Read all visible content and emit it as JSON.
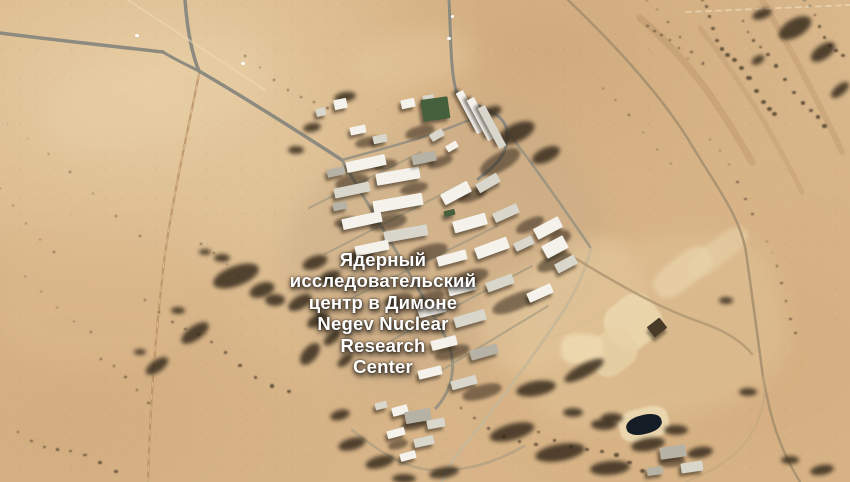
{
  "location_label": {
    "lines": [
      "Ядерный",
      "исследовательский",
      "центр в Димоне",
      "Negev Nuclear",
      "Research",
      "Center"
    ],
    "language_ru": "Ядерный исследовательский центр в Димоне",
    "language_en": "Negev Nuclear Research Center",
    "text_color": "#ffffff"
  },
  "palette": {
    "sand_base": "#d9b78b",
    "sand_light": "#ecd7ae",
    "sand_dark": "#c8a275",
    "road_asphalt": "#8d8a80",
    "dirt_track": "#bb9265",
    "scrub": "#33281a",
    "shadow": "#241a10",
    "bldg": {
      "w": "#f4f2eb",
      "l": "#d9d6cc",
      "g": "#b6b2a6",
      "green": "#44603c",
      "pond": "#141c25",
      "pit": "#4a3b28",
      "dot": "#ffffff"
    }
  },
  "scene": {
    "pads": [
      [
        445,
        245,
        310,
        240,
        -30,
        "#c9ab87",
        0.5,
        14
      ],
      [
        560,
        305,
        170,
        100,
        -30,
        "#e5c99e",
        0.5,
        8
      ],
      [
        650,
        330,
        270,
        180,
        -12,
        "#e2c79b",
        0.45,
        10
      ],
      [
        155,
        95,
        220,
        80,
        -15,
        "#e8d0a6",
        0.45,
        12
      ],
      [
        95,
        300,
        190,
        130,
        0,
        "#debb8f",
        0.4,
        12
      ],
      [
        410,
        60,
        120,
        50,
        -10,
        "#e6cda2",
        0.4,
        10
      ],
      [
        745,
        180,
        160,
        90,
        -20,
        "#d7b488",
        0.4,
        12
      ],
      [
        633,
        322,
        54,
        50,
        -38,
        "#ecd7ae",
        0.9,
        1
      ],
      [
        612,
        352,
        48,
        42,
        -38,
        "#e7d0a5",
        0.9,
        1
      ],
      [
        683,
        272,
        66,
        30,
        -38,
        "#ead5ab",
        0.7,
        2
      ],
      [
        718,
        252,
        70,
        24,
        -38,
        "#e7d2a8",
        0.6,
        2
      ],
      [
        582,
        349,
        42,
        30,
        0,
        "#eed9b0",
        0.9,
        2
      ],
      [
        644,
        424,
        50,
        32,
        -14,
        "#ecd8b0",
        0.95,
        1
      ]
    ],
    "roads": [
      [
        "M640,18 C692,62 722,110 752,162",
        "rgba(150,108,66,0.18)",
        7,
        1,
        ""
      ],
      [
        "M762,0 C792,52 816,96 842,152",
        "rgba(150,108,66,0.18)",
        6,
        1,
        ""
      ],
      [
        "M700,28 C742,82 772,132 802,192",
        "rgba(150,108,66,0.15)",
        5,
        1,
        ""
      ],
      [
        "M0,33 C55,40 110,46 163,52",
        "#8d8a80",
        3.5,
        1,
        ""
      ],
      [
        "M185,0 C187,26 191,52 199,71",
        "#8d8a80",
        3.5,
        1,
        ""
      ],
      [
        "M163,52 C176,60 189,66 199,71",
        "#8d8a80",
        3,
        1,
        ""
      ],
      [
        "M199,71 C252,102 308,138 342,160",
        "#8d8a80",
        3.5,
        1,
        ""
      ],
      [
        "M342,160 C372,212 412,275 447,340 C458,366 452,390 436,408",
        "#98917f",
        3,
        0.95,
        ""
      ],
      [
        "M342,160 C378,150 410,142 438,132 C458,125 472,119 483,114",
        "#969082",
        2.5,
        0.9,
        ""
      ],
      [
        "M449,0 C451,35 450,72 457,94 C479,111 503,109 507,131 C510,154 494,167 478,179",
        "#8d8a80",
        3,
        1,
        ""
      ],
      [
        "M507,131 C532,163 558,200 582,235 C586,241 590,246 591,249",
        "#9a937f",
        2.5,
        0.9,
        ""
      ],
      [
        "M591,249 C581,288 561,316 536,351 C516,379 486,420 451,462 L442,482",
        "#c9b796",
        3,
        0.95,
        ""
      ],
      [
        "M570,255 C622,287 662,309 700,322 C726,331 741,341 752,354",
        "#b39a75",
        2.5,
        0.9,
        ""
      ],
      [
        "M568,0 C616,46 662,96 691,144 C716,186 740,216 746,252 C753,302 757,332 763,377 C771,422 781,451 800,482",
        "#a6906f",
        2.5,
        0.9,
        ""
      ],
      [
        "M199,74 C188,130 172,200 164,262 C156,330 150,400 148,482",
        "#bb9265",
        2.2,
        0.85,
        ""
      ],
      [
        "M199,74 C188,130 172,200 164,262 C156,330 150,400 148,482",
        "#ecd9b2",
        1,
        0.6,
        "5,7"
      ],
      [
        "M128,0 L265,90",
        "#ecd9b4",
        2,
        0.6,
        ""
      ],
      [
        "M686,12 L850,5",
        "#f0e3c4",
        1.8,
        0.6,
        "5,5"
      ],
      [
        "M309,208 L421,152",
        "#a1987f",
        2,
        0.75,
        ""
      ],
      [
        "M325,254 L458,186",
        "#a1987f",
        2,
        0.75,
        ""
      ],
      [
        "M348,300 L497,226",
        "#a1987f",
        2,
        0.75,
        ""
      ],
      [
        "M392,340 L532,266",
        "#a1987f",
        2,
        0.75,
        ""
      ],
      [
        "M432,376 L548,306",
        "#a1987f",
        2,
        0.7,
        ""
      ],
      [
        "M352,430 C380,452 404,468 432,470 C468,472 500,460 524,446",
        "#b4a183",
        2.5,
        0.85,
        ""
      ],
      [
        "M763,377 C768,402 758,430 737,452 C719,468 700,476 686,482",
        "#c2a77f",
        2,
        0.6,
        ""
      ],
      [
        "M548,338 C570,332 590,322 606,310",
        "#d8bd92",
        2,
        0.7,
        ""
      ]
    ],
    "scrub": [
      [
        236,
        276,
        48,
        20,
        -20
      ],
      [
        262,
        290,
        26,
        14,
        -20
      ],
      [
        275,
        300,
        20,
        12,
        0
      ],
      [
        195,
        333,
        32,
        14,
        -35
      ],
      [
        157,
        366,
        26,
        12,
        -35
      ],
      [
        300,
        302,
        26,
        13,
        -30
      ],
      [
        318,
        320,
        24,
        12,
        -30
      ],
      [
        310,
        354,
        26,
        14,
        -50
      ],
      [
        222,
        258,
        16,
        8,
        0
      ],
      [
        205,
        252,
        12,
        6,
        0
      ],
      [
        178,
        310,
        14,
        7,
        0
      ],
      [
        140,
        352,
        12,
        6,
        0
      ],
      [
        332,
        338,
        20,
        10,
        -40
      ],
      [
        345,
        360,
        18,
        9,
        -40
      ],
      [
        315,
        262,
        26,
        13,
        -20
      ],
      [
        330,
        276,
        22,
        11,
        -20
      ],
      [
        352,
        444,
        28,
        12,
        -15
      ],
      [
        380,
        462,
        30,
        12,
        -15
      ],
      [
        340,
        415,
        20,
        10,
        -15
      ],
      [
        795,
        28,
        36,
        18,
        -30
      ],
      [
        823,
        52,
        28,
        14,
        -35
      ],
      [
        762,
        14,
        20,
        10,
        -20
      ],
      [
        840,
        90,
        22,
        10,
        -40
      ],
      [
        758,
        60,
        14,
        8,
        -30
      ],
      [
        345,
        97,
        22,
        10,
        -10
      ],
      [
        312,
        127,
        18,
        9,
        -10
      ],
      [
        296,
        150,
        16,
        8,
        0
      ],
      [
        516,
        133,
        40,
        18,
        -25
      ],
      [
        546,
        155,
        30,
        14,
        -25
      ],
      [
        490,
        112,
        24,
        11,
        -20
      ],
      [
        536,
        388,
        40,
        15,
        -10
      ],
      [
        512,
        432,
        46,
        16,
        -15
      ],
      [
        560,
        452,
        50,
        17,
        -10
      ],
      [
        610,
        468,
        40,
        14,
        -5
      ],
      [
        648,
        444,
        34,
        13,
        -10
      ],
      [
        604,
        424,
        26,
        11,
        0
      ],
      [
        676,
        430,
        24,
        10,
        0
      ],
      [
        700,
        452,
        26,
        11,
        -10
      ],
      [
        584,
        370,
        44,
        13,
        -28
      ],
      [
        573,
        412,
        20,
        9,
        0
      ],
      [
        612,
        418,
        22,
        10,
        0
      ],
      [
        444,
        472,
        30,
        11,
        -10
      ],
      [
        404,
        478,
        24,
        9,
        0
      ],
      [
        822,
        470,
        24,
        10,
        -10
      ],
      [
        790,
        460,
        18,
        8,
        0
      ],
      [
        748,
        392,
        18,
        8,
        0
      ],
      [
        726,
        300,
        14,
        7,
        0
      ]
    ],
    "chains": [
      [
        700,
        2,
        770,
        115,
        14,
        4
      ],
      [
        745,
        18,
        820,
        130,
        12,
        3.5
      ],
      [
        800,
        2,
        848,
        58,
        8,
        3
      ],
      [
        688,
        58,
        652,
        22,
        6,
        3
      ],
      [
        140,
        300,
        290,
        392,
        11,
        3
      ],
      [
        15,
        432,
        120,
        470,
        8,
        3
      ],
      [
        5,
        192,
        52,
        250,
        5,
        2.5
      ],
      [
        240,
        60,
        330,
        112,
        7,
        2.5
      ],
      [
        10,
        120,
        140,
        232,
        7,
        2
      ],
      [
        540,
        432,
        640,
        470,
        8,
        4
      ],
      [
        462,
        412,
        540,
        446,
        6,
        3.5
      ],
      [
        652,
        2,
        700,
        60,
        6,
        2.5
      ],
      [
        710,
        140,
        748,
        210,
        6,
        2.5
      ],
      [
        762,
        240,
        800,
        330,
        7,
        2.5
      ],
      [
        608,
        90,
        668,
        160,
        6,
        2
      ],
      [
        196,
        248,
        236,
        272,
        4,
        2.5
      ],
      [
        96,
        360,
        150,
        400,
        5,
        2.5
      ],
      [
        30,
        280,
        90,
        330,
        5,
        2
      ]
    ],
    "shade": [
      [
        352,
        182,
        34,
        14,
        -12
      ],
      [
        388,
        222,
        38,
        15,
        -12
      ],
      [
        428,
        252,
        40,
        15,
        -15
      ],
      [
        468,
        278,
        42,
        15,
        -18
      ],
      [
        516,
        302,
        50,
        16,
        -22
      ],
      [
        554,
        262,
        36,
        14,
        -25
      ],
      [
        500,
        162,
        44,
        18,
        -30
      ],
      [
        420,
        132,
        30,
        12,
        -15
      ],
      [
        368,
        142,
        26,
        10,
        -12
      ],
      [
        452,
        352,
        36,
        13,
        -15
      ],
      [
        482,
        392,
        40,
        14,
        -15
      ],
      [
        430,
        298,
        30,
        12,
        -15
      ],
      [
        530,
        225,
        30,
        12,
        -25
      ],
      [
        472,
        195,
        30,
        12,
        -20
      ],
      [
        414,
        188,
        28,
        11,
        -12
      ],
      [
        360,
        255,
        28,
        11,
        -12
      ],
      [
        398,
        300,
        30,
        12,
        -14
      ],
      [
        414,
        425,
        26,
        10,
        -12
      ],
      [
        398,
        444,
        20,
        9,
        -15
      ],
      [
        672,
        462,
        26,
        10,
        -5
      ],
      [
        560,
        238,
        22,
        14,
        -25
      ],
      [
        440,
        162,
        26,
        10,
        -20
      ],
      [
        385,
        165,
        24,
        10,
        -12
      ],
      [
        345,
        222,
        22,
        10,
        -12
      ]
    ],
    "buildings": [
      [
        340,
        104,
        13,
        10,
        -12,
        "w"
      ],
      [
        321,
        112,
        10,
        8,
        -12,
        "l"
      ],
      [
        358,
        130,
        16,
        8,
        -12,
        "w"
      ],
      [
        380,
        139,
        14,
        8,
        -12,
        "l"
      ],
      [
        408,
        103,
        14,
        9,
        -12,
        "w"
      ],
      [
        428,
        99,
        11,
        8,
        -10,
        "l"
      ],
      [
        435,
        109,
        27,
        22,
        -8,
        "green"
      ],
      [
        470,
        112,
        46,
        8,
        62,
        "w"
      ],
      [
        481,
        119,
        46,
        8,
        62,
        "w"
      ],
      [
        492,
        127,
        46,
        8,
        62,
        "l"
      ],
      [
        437,
        135,
        14,
        8,
        -30,
        "l"
      ],
      [
        452,
        146,
        12,
        7,
        -30,
        "w"
      ],
      [
        366,
        163,
        40,
        11,
        -12,
        "w"
      ],
      [
        336,
        172,
        18,
        8,
        -12,
        "g"
      ],
      [
        398,
        176,
        44,
        12,
        -10,
        "w"
      ],
      [
        352,
        190,
        36,
        10,
        -12,
        "l"
      ],
      [
        398,
        203,
        50,
        12,
        -10,
        "w"
      ],
      [
        362,
        220,
        40,
        11,
        -12,
        "w"
      ],
      [
        406,
        233,
        44,
        11,
        -10,
        "l"
      ],
      [
        372,
        248,
        34,
        10,
        -12,
        "w"
      ],
      [
        424,
        158,
        24,
        10,
        -12,
        "g"
      ],
      [
        340,
        206,
        14,
        8,
        -12,
        "g"
      ],
      [
        456,
        193,
        30,
        12,
        -28,
        "w"
      ],
      [
        488,
        183,
        24,
        10,
        -30,
        "l"
      ],
      [
        470,
        223,
        34,
        12,
        -16,
        "w"
      ],
      [
        506,
        213,
        26,
        10,
        -24,
        "l"
      ],
      [
        452,
        258,
        30,
        10,
        -15,
        "w"
      ],
      [
        492,
        248,
        34,
        12,
        -20,
        "w"
      ],
      [
        524,
        243,
        20,
        9,
        -25,
        "l"
      ],
      [
        462,
        288,
        28,
        10,
        -15,
        "w"
      ],
      [
        500,
        283,
        28,
        10,
        -20,
        "l"
      ],
      [
        449,
        213,
        11,
        6,
        -15,
        "green"
      ],
      [
        548,
        228,
        28,
        12,
        -28,
        "w"
      ],
      [
        555,
        247,
        24,
        14,
        -28,
        "w"
      ],
      [
        566,
        264,
        22,
        10,
        -28,
        "l"
      ],
      [
        540,
        293,
        26,
        10,
        -24,
        "w"
      ],
      [
        432,
        310,
        28,
        10,
        -14,
        "w"
      ],
      [
        470,
        318,
        32,
        11,
        -16,
        "l"
      ],
      [
        444,
        343,
        26,
        10,
        -14,
        "w"
      ],
      [
        484,
        352,
        28,
        10,
        -16,
        "g"
      ],
      [
        430,
        372,
        24,
        9,
        -14,
        "w"
      ],
      [
        464,
        382,
        26,
        9,
        -15,
        "l"
      ],
      [
        381,
        405,
        12,
        7,
        -15,
        "l"
      ],
      [
        400,
        410,
        16,
        9,
        -15,
        "w"
      ],
      [
        418,
        416,
        26,
        12,
        -10,
        "g"
      ],
      [
        436,
        423,
        18,
        9,
        -10,
        "l"
      ],
      [
        396,
        433,
        18,
        8,
        -15,
        "w"
      ],
      [
        424,
        441,
        20,
        9,
        -12,
        "l"
      ],
      [
        408,
        456,
        16,
        8,
        -15,
        "w"
      ],
      [
        673,
        452,
        26,
        12,
        -8,
        "g"
      ],
      [
        692,
        467,
        22,
        10,
        -8,
        "l"
      ],
      [
        655,
        471,
        16,
        8,
        -8,
        "g"
      ],
      [
        657,
        327,
        16,
        13,
        -38,
        "pit"
      ],
      [
        644,
        424,
        36,
        19,
        -14,
        "pond"
      ],
      [
        137,
        35,
        4,
        3,
        0,
        "dot"
      ],
      [
        243,
        63,
        4,
        3,
        0,
        "dot"
      ],
      [
        449,
        38,
        4,
        3,
        0,
        "dot"
      ],
      [
        452,
        16,
        3,
        3,
        0,
        "dot"
      ]
    ]
  }
}
